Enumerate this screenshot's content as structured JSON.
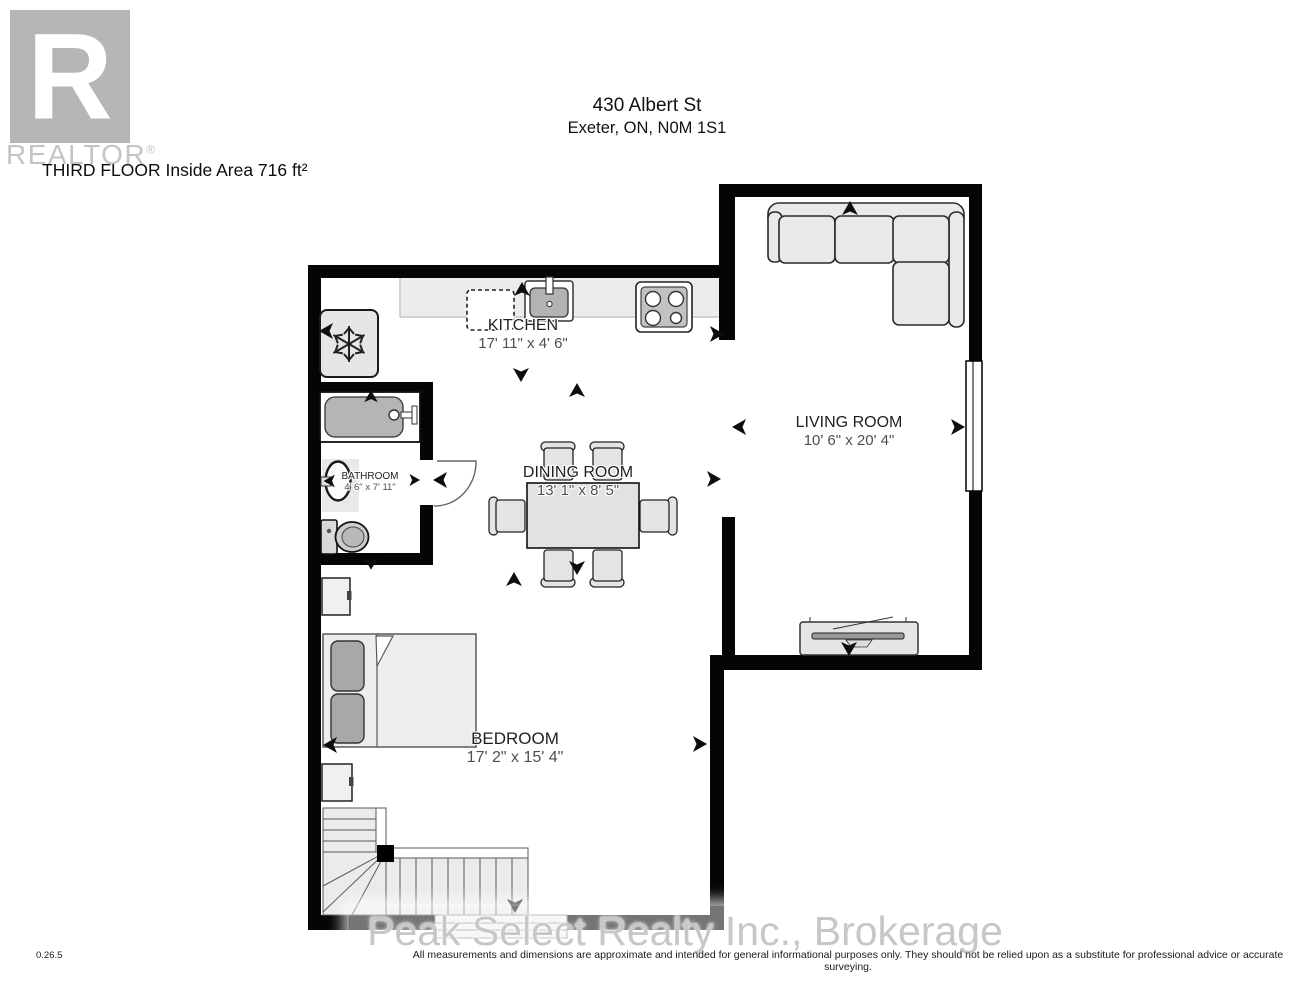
{
  "header": {
    "address_line1": "430 Albert St",
    "address_line2": "Exeter, ON, N0M 1S1",
    "floor_label": "THIRD FLOOR",
    "area_label": "Inside Area 716 ft²"
  },
  "branding": {
    "logo_letter": "R",
    "logo_text": "REALTOR",
    "registered_mark": "®",
    "brokerage_watermark": "Peak Select Realty Inc., Brokerage"
  },
  "rooms": {
    "kitchen": {
      "name": "KITCHEN",
      "dims": "17' 11\" x 4' 6\""
    },
    "living": {
      "name": "LIVING ROOM",
      "dims": "10' 6\" x 20' 4\""
    },
    "dining": {
      "name": "DINING ROOM",
      "dims": "13' 1\" x 8' 5\""
    },
    "bathroom": {
      "name": "BATHROOM",
      "dims": "4' 6\" x 7' 11\""
    },
    "bedroom": {
      "name": "BEDROOM",
      "dims": "17' 2\" x 15' 4\""
    }
  },
  "footer": {
    "version": "0.26.5",
    "disclaimer": "All measurements and dimensions are approximate and intended for general informational purposes only. They should not be relied upon as a substitute for professional advice or accurate surveying."
  },
  "colors": {
    "wall": "#000000",
    "furniture_fill": "#e9e9e9",
    "fixture_gray": "#b5b5b5",
    "watermark_gray": "#c6c6c6"
  }
}
